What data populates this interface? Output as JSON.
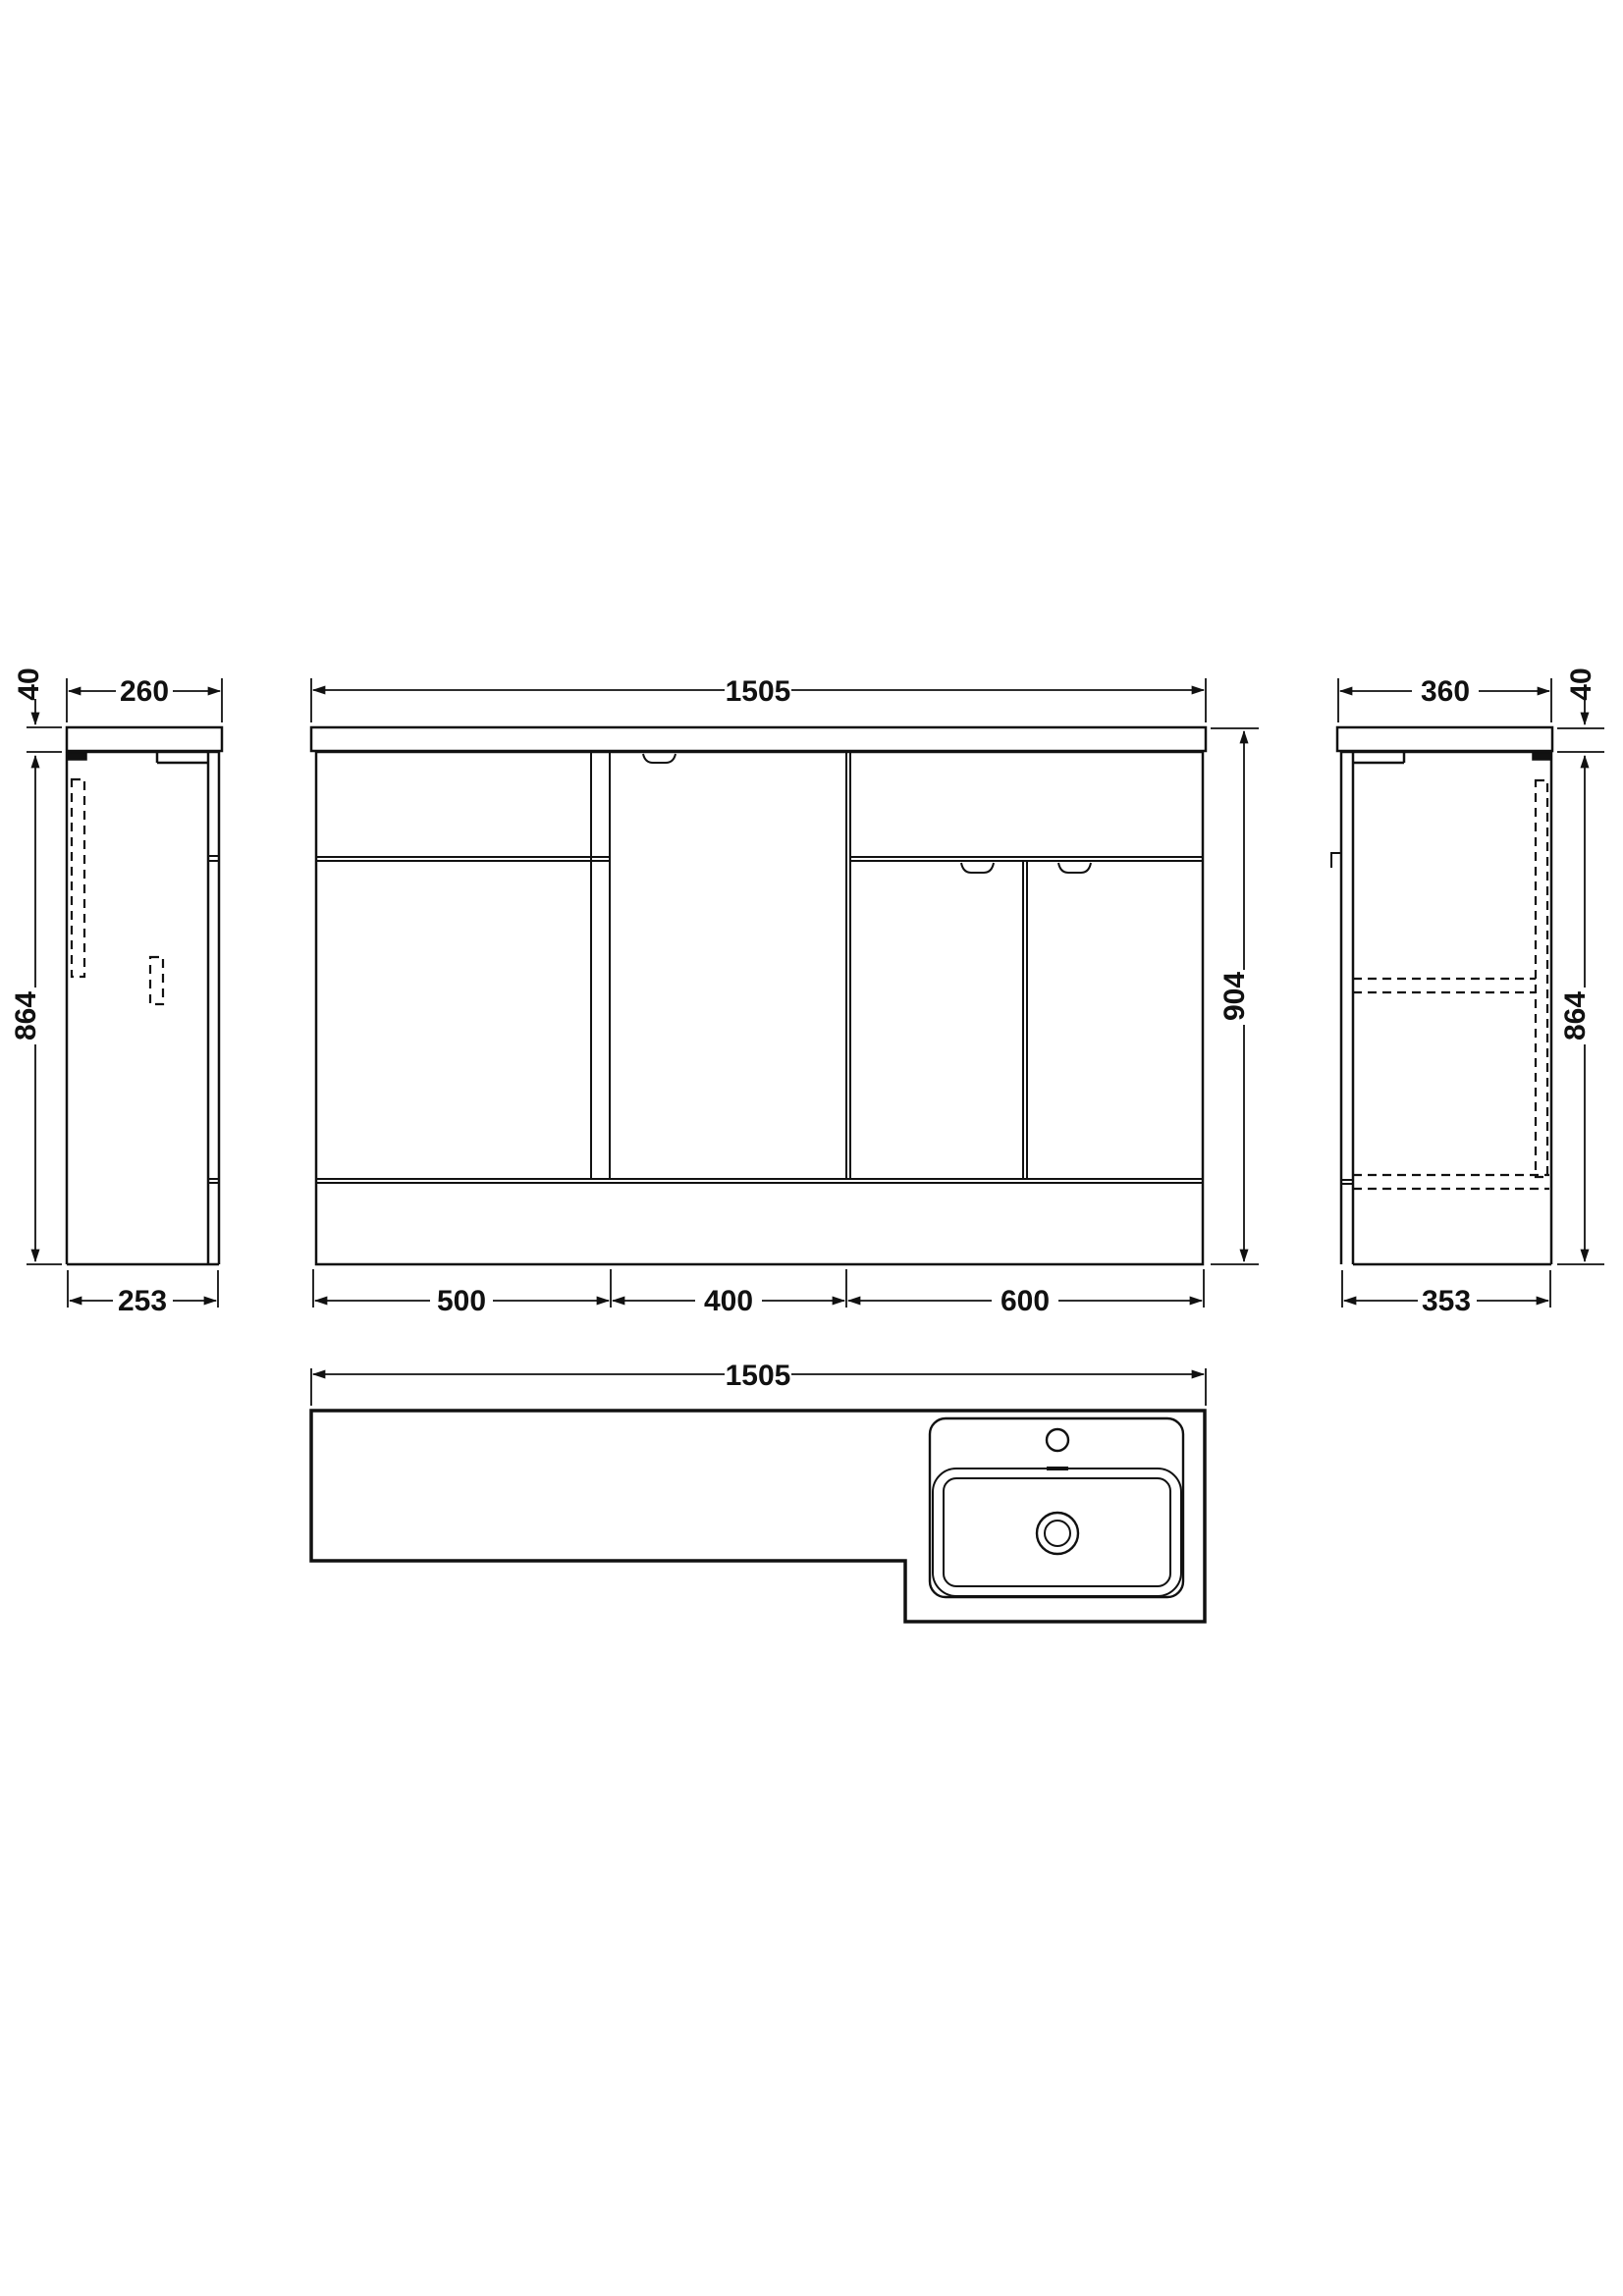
{
  "drawing_labels": {
    "left_view": {
      "countertop_thickness": "40",
      "countertop_depth": "260",
      "cabinet_height": "864",
      "cabinet_depth": "253"
    },
    "front_view": {
      "total_width": "1505",
      "total_height": "904",
      "section_widths": [
        "500",
        "400",
        "600"
      ]
    },
    "right_view": {
      "countertop_depth": "360",
      "countertop_thickness": "40",
      "cabinet_height": "864",
      "cabinet_depth": "353"
    },
    "plan_view": {
      "total_width": "1505"
    }
  },
  "colors": {
    "line": "#111111",
    "background": "#ffffff"
  }
}
